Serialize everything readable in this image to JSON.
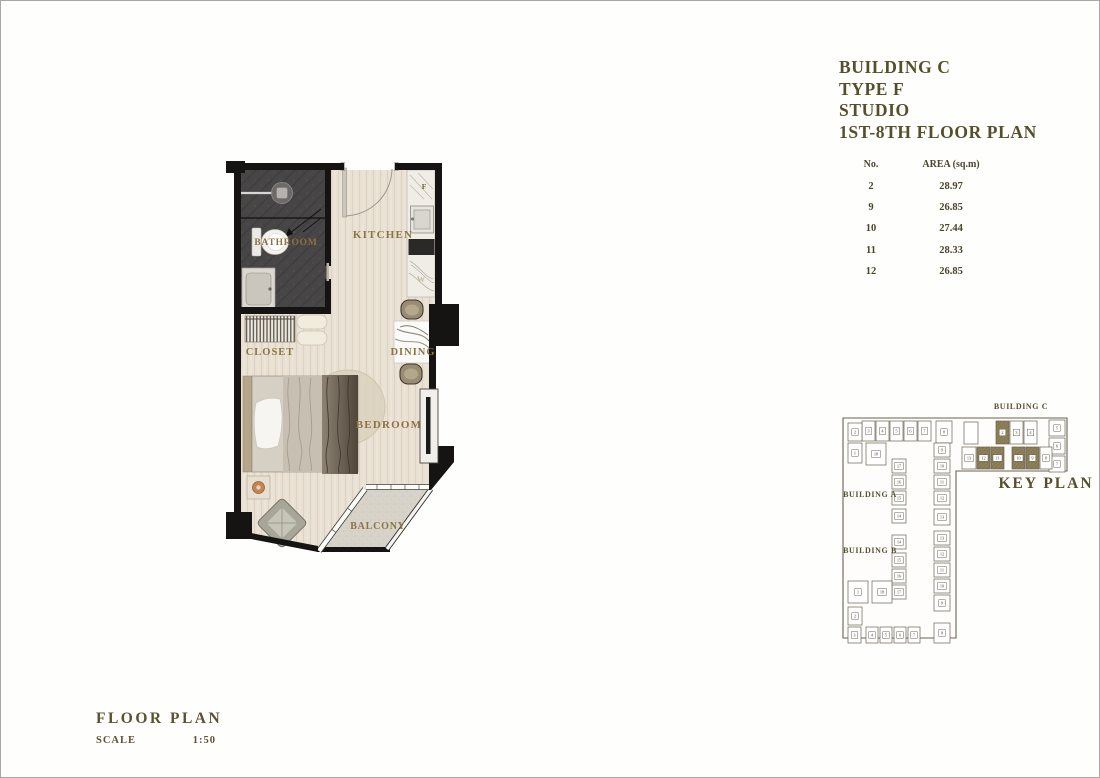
{
  "title_block": {
    "line1": "BUILDING C",
    "line2": "TYPE F",
    "line3": "STUDIO",
    "line4": "1ST-8TH FLOOR PLAN"
  },
  "area_table": {
    "col_no": "No.",
    "col_area": "AREA (sq.m)",
    "rows": [
      {
        "no": "2",
        "area": "28.97"
      },
      {
        "no": "9",
        "area": "26.85"
      },
      {
        "no": "10",
        "area": "27.44"
      },
      {
        "no": "11",
        "area": "28.33"
      },
      {
        "no": "12",
        "area": "26.85"
      }
    ]
  },
  "floor_plan": {
    "labels": {
      "bathroom": "BATHROOM",
      "kitchen": "KITCHEN",
      "closet": "CLOSET",
      "dining": "DINING",
      "bedroom": "BEDROOM",
      "balcony": "BALCONY",
      "fridge": "F",
      "washer": "W"
    },
    "label_color": "#8a7444",
    "wall_color": "#161412",
    "floor_color": "#e8e0d2",
    "bathroom_floor_color": "#484546",
    "balcony_floor_color": "#d8d3c9"
  },
  "key_plan": {
    "title": "KEY PLAN",
    "building_a": "BUILDING A",
    "building_b": "BUILDING B",
    "building_c": "BUILDING C",
    "outline_color": "#6b6253",
    "highlight_color": "#8d8159",
    "highlighted_units": [
      "2",
      "9",
      "10",
      "11",
      "12"
    ],
    "cells": [
      {
        "x": 130,
        "y": 25,
        "w": 14,
        "h": 22,
        "n": ""
      },
      {
        "x": 162,
        "y": 24,
        "w": 13,
        "h": 23,
        "n": "2",
        "hl": true
      },
      {
        "x": 176,
        "y": 24,
        "w": 13,
        "h": 23,
        "n": "3"
      },
      {
        "x": 190,
        "y": 24,
        "w": 13,
        "h": 23,
        "n": "4"
      },
      {
        "x": 215,
        "y": 23,
        "w": 16,
        "h": 16,
        "n": "5"
      },
      {
        "x": 215,
        "y": 41,
        "w": 16,
        "h": 16,
        "n": "6"
      },
      {
        "x": 215,
        "y": 59,
        "w": 16,
        "h": 16,
        "n": "7"
      },
      {
        "x": 128,
        "y": 50,
        "w": 14,
        "h": 22,
        "n": "13"
      },
      {
        "x": 143,
        "y": 50,
        "w": 13,
        "h": 22,
        "n": "12",
        "hl": true
      },
      {
        "x": 157,
        "y": 50,
        "w": 13,
        "h": 22,
        "n": "11",
        "hl": true
      },
      {
        "x": 178,
        "y": 50,
        "w": 13,
        "h": 22,
        "n": "10",
        "hl": true
      },
      {
        "x": 192,
        "y": 50,
        "w": 13,
        "h": 22,
        "n": "9",
        "hl": true
      },
      {
        "x": 206,
        "y": 50,
        "w": 12,
        "h": 22,
        "n": "8"
      },
      {
        "x": 28,
        "y": 24,
        "w": 13,
        "h": 20,
        "n": "3"
      },
      {
        "x": 42,
        "y": 24,
        "w": 13,
        "h": 20,
        "n": "4"
      },
      {
        "x": 56,
        "y": 24,
        "w": 13,
        "h": 20,
        "n": "5"
      },
      {
        "x": 70,
        "y": 24,
        "w": 13,
        "h": 20,
        "n": "6"
      },
      {
        "x": 84,
        "y": 24,
        "w": 13,
        "h": 20,
        "n": "7"
      },
      {
        "x": 102,
        "y": 24,
        "w": 16,
        "h": 22,
        "n": "8"
      },
      {
        "x": 14,
        "y": 26,
        "w": 14,
        "h": 18,
        "n": "2"
      },
      {
        "x": 14,
        "y": 46,
        "w": 14,
        "h": 20,
        "n": "1"
      },
      {
        "x": 32,
        "y": 46,
        "w": 20,
        "h": 22,
        "n": "18"
      },
      {
        "x": 58,
        "y": 62,
        "w": 14,
        "h": 14,
        "n": "17"
      },
      {
        "x": 58,
        "y": 78,
        "w": 14,
        "h": 14,
        "n": "16"
      },
      {
        "x": 58,
        "y": 94,
        "w": 14,
        "h": 14,
        "n": "15"
      },
      {
        "x": 58,
        "y": 112,
        "w": 14,
        "h": 14,
        "n": "14"
      },
      {
        "x": 100,
        "y": 46,
        "w": 16,
        "h": 14,
        "n": "9"
      },
      {
        "x": 100,
        "y": 62,
        "w": 16,
        "h": 14,
        "n": "10"
      },
      {
        "x": 100,
        "y": 78,
        "w": 16,
        "h": 14,
        "n": "11"
      },
      {
        "x": 100,
        "y": 94,
        "w": 16,
        "h": 14,
        "n": "12"
      },
      {
        "x": 100,
        "y": 112,
        "w": 16,
        "h": 16,
        "n": "13"
      },
      {
        "x": 58,
        "y": 138,
        "w": 14,
        "h": 14,
        "n": "14"
      },
      {
        "x": 58,
        "y": 156,
        "w": 14,
        "h": 14,
        "n": "15"
      },
      {
        "x": 58,
        "y": 172,
        "w": 14,
        "h": 14,
        "n": "16"
      },
      {
        "x": 58,
        "y": 188,
        "w": 14,
        "h": 14,
        "n": "17"
      },
      {
        "x": 100,
        "y": 134,
        "w": 16,
        "h": 14,
        "n": "13"
      },
      {
        "x": 100,
        "y": 150,
        "w": 16,
        "h": 14,
        "n": "12"
      },
      {
        "x": 100,
        "y": 166,
        "w": 16,
        "h": 14,
        "n": "11"
      },
      {
        "x": 100,
        "y": 182,
        "w": 16,
        "h": 14,
        "n": "10"
      },
      {
        "x": 100,
        "y": 198,
        "w": 16,
        "h": 16,
        "n": "9"
      },
      {
        "x": 14,
        "y": 184,
        "w": 20,
        "h": 22,
        "n": "1"
      },
      {
        "x": 38,
        "y": 184,
        "w": 20,
        "h": 22,
        "n": "18"
      },
      {
        "x": 14,
        "y": 210,
        "w": 14,
        "h": 18,
        "n": "2"
      },
      {
        "x": 14,
        "y": 230,
        "w": 13,
        "h": 16,
        "n": "3"
      },
      {
        "x": 32,
        "y": 230,
        "w": 12,
        "h": 16,
        "n": "4"
      },
      {
        "x": 46,
        "y": 230,
        "w": 12,
        "h": 16,
        "n": "5"
      },
      {
        "x": 60,
        "y": 230,
        "w": 12,
        "h": 16,
        "n": "6"
      },
      {
        "x": 74,
        "y": 230,
        "w": 12,
        "h": 16,
        "n": "7"
      },
      {
        "x": 100,
        "y": 226,
        "w": 16,
        "h": 20,
        "n": "8"
      }
    ]
  },
  "footer": {
    "title": "FLOOR PLAN",
    "scale_label": "SCALE",
    "scale_value": "1:50"
  }
}
